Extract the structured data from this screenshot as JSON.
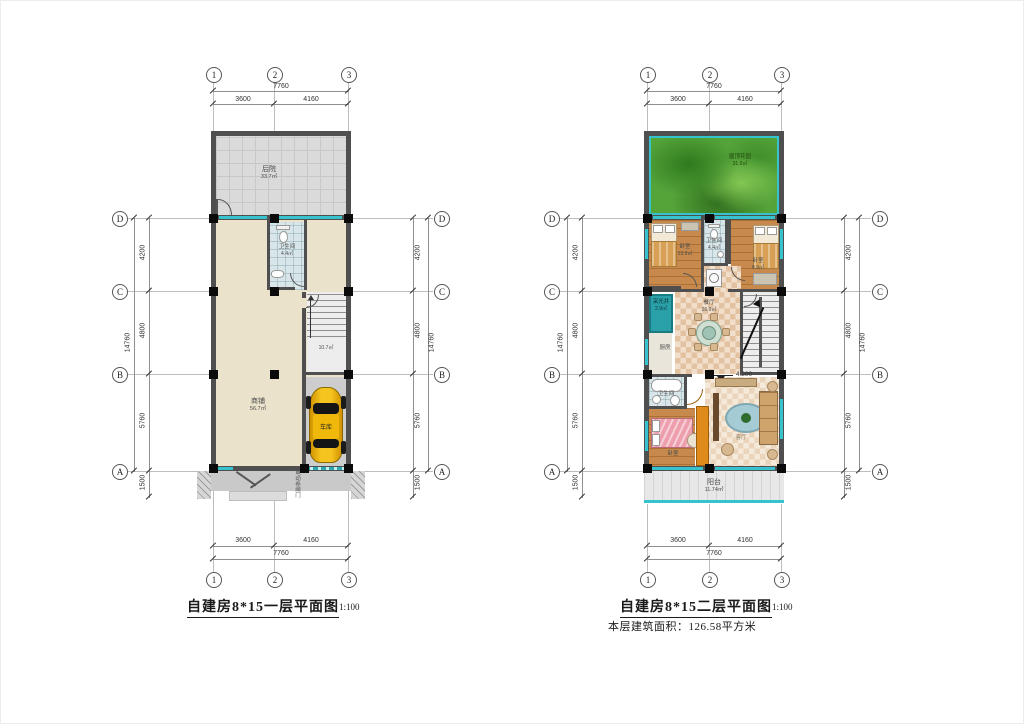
{
  "shared": {
    "scale_label": "1:100",
    "grid_cols": [
      "1",
      "2",
      "3"
    ],
    "grid_rows": [
      "D",
      "C",
      "B",
      "A"
    ],
    "dims": {
      "top_total": "7760",
      "span_left": "3600",
      "span_right": "4160",
      "row_dc": "4200",
      "row_cb": "4800",
      "row_ba": "5760",
      "side_total": "14760",
      "front_offset": "1500",
      "bottom_total": "7760"
    }
  },
  "plan1": {
    "title": "自建房8*15一层平面图",
    "rooms": {
      "backyard_name": "后院",
      "backyard_area": "33.7㎡",
      "bath_name": "卫生间",
      "bath_area": "4.4㎡",
      "shop_name": "商铺",
      "shop_area": "56.7㎡",
      "stair_area": "10.7㎡",
      "garage_name": "车库",
      "garage_door_note": "电动卷闸门"
    }
  },
  "plan2": {
    "title": "自建房8*15二层平面图",
    "area_note": "本层建筑面积：126.58平方米",
    "level_mark": "4.200",
    "rooms": {
      "garden_name": "屋顶花园",
      "garden_area": "31.0㎡",
      "bed1_name": "卧室",
      "bed1_area": "13.9㎡",
      "bath1_name": "卫生间",
      "bath1_area": "4.4㎡",
      "bed2_name": "卧室",
      "bed2_area": "8.9㎡",
      "lightwell_name": "采光井",
      "lightwell_area": "2.9㎡",
      "kitchen_name": "厨房",
      "dining_name": "餐厅",
      "dining_area": "26.9㎡",
      "bath2_name": "卫生间",
      "bath2_area": "3.6㎡",
      "bed3_name": "卧室",
      "living_name": "客厅",
      "balcony_name": "阳台",
      "balcony_area": "11.74㎡"
    }
  }
}
